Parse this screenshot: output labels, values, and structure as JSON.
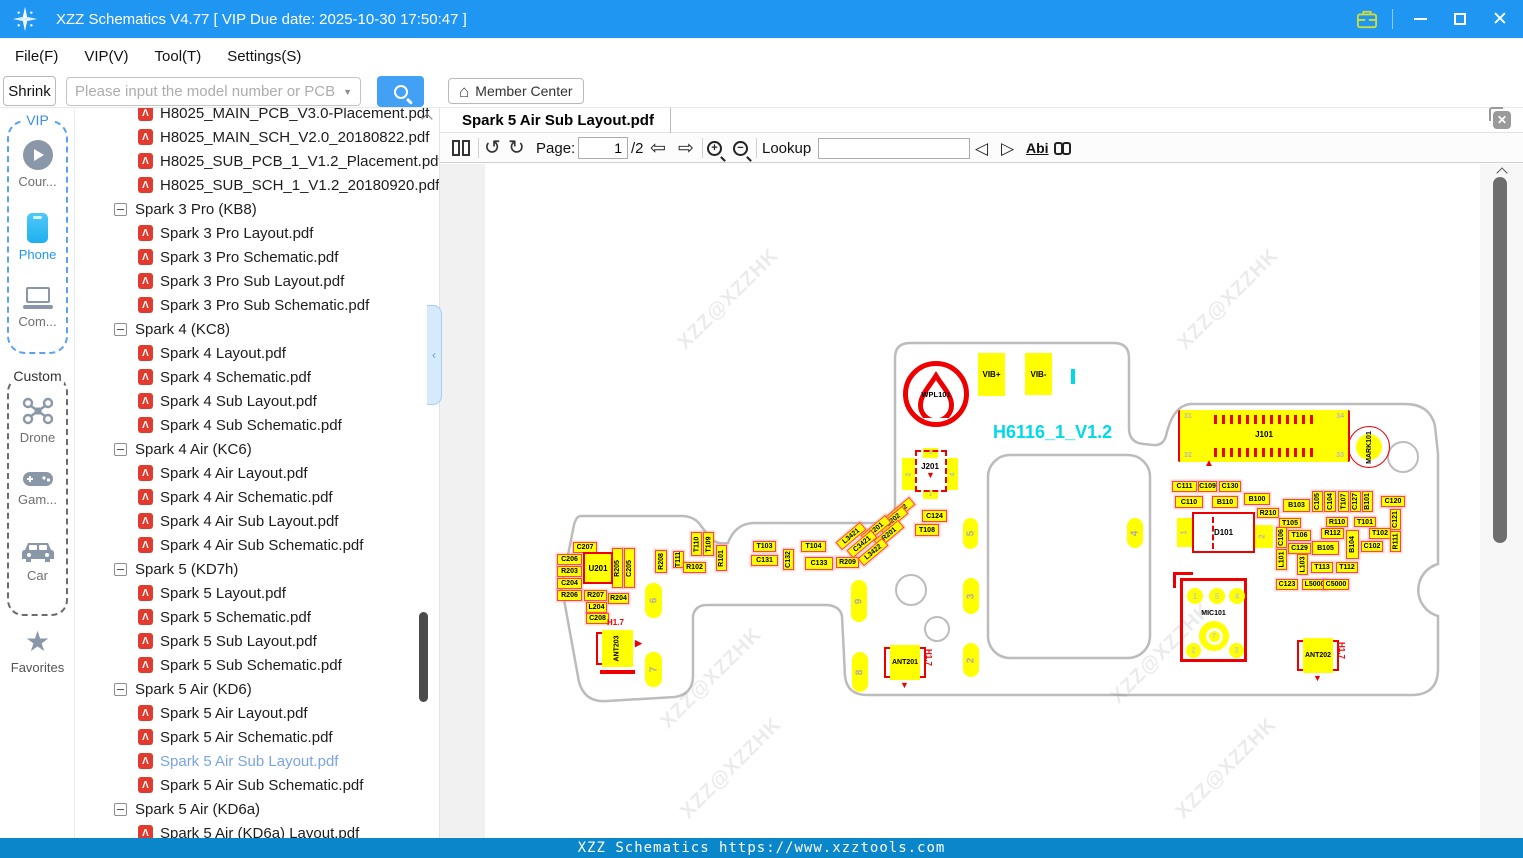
{
  "titlebar": {
    "title": "XZZ Schematics V4.77 [ VIP Due date: 2025-10-30 17:50:47 ]"
  },
  "menubar": {
    "items": [
      "File(F)",
      "VIP(V)",
      "Tool(T)",
      "Settings(S)"
    ]
  },
  "searchbar": {
    "shrink_label": "Shrink",
    "placeholder": "Please input the model number or PCB",
    "member_center_label": "Member Center"
  },
  "sidebar": {
    "vip_label": "VIP",
    "custom_label": "Custom",
    "favorites_label": "Favorites",
    "vip_items": [
      {
        "label": "Cour...",
        "icon": "play-circle-icon"
      },
      {
        "label": "Phone",
        "icon": "phone-icon",
        "active": true
      },
      {
        "label": "Com...",
        "icon": "laptop-icon"
      }
    ],
    "custom_items": [
      {
        "label": "Drone",
        "icon": "drone-icon"
      },
      {
        "label": "Gam...",
        "icon": "gamepad-icon"
      },
      {
        "label": "Car",
        "icon": "car-icon"
      }
    ]
  },
  "tree": {
    "items": [
      {
        "type": "file",
        "label": "H8025_MAIN_PCB_V3.0-Placement.pdf"
      },
      {
        "type": "file",
        "label": "H8025_MAIN_SCH_V2.0_20180822.pdf"
      },
      {
        "type": "file",
        "label": "H8025_SUB_PCB_1_V1.2_Placement.pdf"
      },
      {
        "type": "file",
        "label": "H8025_SUB_SCH_1_V1.2_20180920.pdf"
      },
      {
        "type": "group",
        "label": "Spark 3 Pro (KB8)"
      },
      {
        "type": "file",
        "label": "Spark 3 Pro Layout.pdf"
      },
      {
        "type": "file",
        "label": "Spark 3 Pro Schematic.pdf"
      },
      {
        "type": "file",
        "label": "Spark 3 Pro Sub Layout.pdf"
      },
      {
        "type": "file",
        "label": "Spark 3 Pro Sub Schematic.pdf"
      },
      {
        "type": "group",
        "label": "Spark 4 (KC8)"
      },
      {
        "type": "file",
        "label": "Spark 4 Layout.pdf"
      },
      {
        "type": "file",
        "label": "Spark 4 Schematic.pdf"
      },
      {
        "type": "file",
        "label": "Spark 4 Sub Layout.pdf"
      },
      {
        "type": "file",
        "label": "Spark 4 Sub Schematic.pdf"
      },
      {
        "type": "group",
        "label": "Spark 4 Air (KC6)"
      },
      {
        "type": "file",
        "label": "Spark 4 Air Layout.pdf"
      },
      {
        "type": "file",
        "label": "Spark 4 Air Schematic.pdf"
      },
      {
        "type": "file",
        "label": "Spark 4 Air Sub Layout.pdf"
      },
      {
        "type": "file",
        "label": "Spark 4 Air Sub Schematic.pdf"
      },
      {
        "type": "group",
        "label": "Spark 5 (KD7h)"
      },
      {
        "type": "file",
        "label": "Spark 5 Layout.pdf"
      },
      {
        "type": "file",
        "label": "Spark 5 Schematic.pdf"
      },
      {
        "type": "file",
        "label": "Spark 5 Sub Layout.pdf"
      },
      {
        "type": "file",
        "label": "Spark 5 Sub Schematic.pdf"
      },
      {
        "type": "group",
        "label": "Spark 5 Air (KD6)"
      },
      {
        "type": "file",
        "label": "Spark 5 Air Layout.pdf"
      },
      {
        "type": "file",
        "label": "Spark 5 Air Schematic.pdf"
      },
      {
        "type": "file",
        "label": "Spark 5 Air Sub Layout.pdf",
        "selected": true
      },
      {
        "type": "file",
        "label": "Spark 5 Air Sub Schematic.pdf"
      },
      {
        "type": "group",
        "label": "Spark 5 Air (KD6a)"
      },
      {
        "type": "file",
        "label": "Spark 5 Air (KD6a) Layout.pdf"
      }
    ]
  },
  "tabbar": {
    "active_tab": "Spark 5 Air Sub Layout.pdf"
  },
  "viewer_toolbar": {
    "page_label": "Page:",
    "page_value": "1",
    "page_total": "/2",
    "lookup_label": "Lookup",
    "lookup_value": "",
    "abi_label": "Abi"
  },
  "statusbar": {
    "text": "XZZ Schematics https://www.xzztools.com"
  },
  "pcb": {
    "board_title": "H6116_1_V1.2",
    "watermark_text": "XZZ@XZZHK",
    "colors": {
      "component": "#ffff00",
      "marking": "#ee0000",
      "outline": "#bcbcbc",
      "cyan": "#00d9e8"
    },
    "watermarks": [
      [
        247,
        136
      ],
      [
        747,
        136
      ],
      [
        230,
        515
      ],
      [
        680,
        490
      ],
      [
        250,
        605
      ],
      [
        745,
        605
      ]
    ],
    "labels": [
      [
        "C207",
        88,
        378,
        24,
        11,
        0
      ],
      [
        "C206",
        72,
        390,
        25,
        11,
        0
      ],
      [
        "R203",
        72,
        402,
        25,
        11,
        0
      ],
      [
        "C204",
        72,
        414,
        25,
        11,
        0
      ],
      [
        "R206",
        72,
        426,
        25,
        11,
        0
      ],
      [
        "R207",
        99,
        426,
        23,
        11,
        0
      ],
      [
        "R204",
        123,
        429,
        21,
        11,
        0
      ],
      [
        "L204",
        101,
        438,
        21,
        11,
        0
      ],
      [
        "C208",
        101,
        449,
        23,
        11,
        0
      ],
      [
        "R205",
        127,
        384,
        11,
        40,
        1
      ],
      [
        "C205",
        139,
        384,
        11,
        40,
        1
      ],
      [
        "R208",
        170,
        386,
        12,
        23,
        1
      ],
      [
        "T111",
        188,
        387,
        11,
        17,
        1
      ],
      [
        "T110",
        206,
        368,
        11,
        24,
        1
      ],
      [
        "T109",
        218,
        368,
        11,
        24,
        1
      ],
      [
        "R102",
        198,
        398,
        23,
        11,
        0
      ],
      [
        "R101",
        231,
        381,
        11,
        26,
        1
      ],
      [
        "T103",
        268,
        377,
        23,
        11,
        0
      ],
      [
        "C131",
        266,
        391,
        27,
        11,
        0
      ],
      [
        "C132",
        298,
        385,
        11,
        21,
        1
      ],
      [
        "T104",
        316,
        377,
        25,
        11,
        0
      ],
      [
        "C133",
        320,
        393,
        28,
        13,
        0
      ],
      [
        "R209",
        351,
        393,
        23,
        11,
        0
      ],
      [
        "C124",
        437,
        346,
        25,
        12,
        0
      ],
      [
        "T108",
        430,
        360,
        24,
        12,
        0
      ],
      [
        "C111",
        687,
        317,
        25,
        11,
        0
      ],
      [
        "C109",
        713,
        317,
        19,
        11,
        0
      ],
      [
        "C130",
        734,
        317,
        22,
        11,
        0
      ],
      [
        "C110",
        690,
        332,
        28,
        12,
        0
      ],
      [
        "B110",
        727,
        332,
        26,
        12,
        0
      ],
      [
        "B100",
        759,
        329,
        26,
        12,
        0
      ],
      [
        "B103",
        798,
        335,
        27,
        13,
        0
      ],
      [
        "R210",
        772,
        344,
        22,
        10,
        0
      ],
      [
        "T105",
        794,
        354,
        22,
        10,
        0
      ],
      [
        "C105",
        827,
        327,
        11,
        21,
        1
      ],
      [
        "C104",
        839,
        327,
        12,
        21,
        1
      ],
      [
        "T107",
        853,
        327,
        11,
        21,
        1
      ],
      [
        "C127",
        865,
        327,
        11,
        21,
        1
      ],
      [
        "B101",
        877,
        327,
        11,
        21,
        1
      ],
      [
        "C120",
        896,
        332,
        24,
        11,
        0
      ],
      [
        "C121",
        905,
        345,
        11,
        21,
        1
      ],
      [
        "R110",
        841,
        353,
        22,
        10,
        0
      ],
      [
        "T101",
        869,
        353,
        22,
        10,
        0
      ],
      [
        "R112",
        836,
        364,
        23,
        11,
        0
      ],
      [
        "T102",
        884,
        364,
        22,
        11,
        0
      ],
      [
        "R111",
        905,
        367,
        11,
        21,
        1
      ],
      [
        "C106",
        791,
        363,
        11,
        21,
        1
      ],
      [
        "T106",
        803,
        366,
        23,
        11,
        0
      ],
      [
        "B104",
        861,
        366,
        13,
        29,
        1
      ],
      [
        "C102",
        876,
        377,
        22,
        11,
        0
      ],
      [
        "C129",
        803,
        379,
        23,
        11,
        0
      ],
      [
        "B105",
        827,
        377,
        27,
        14,
        0
      ],
      [
        "L101",
        791,
        385,
        11,
        21,
        1
      ],
      [
        "L103",
        812,
        390,
        11,
        21,
        1
      ],
      [
        "T113",
        826,
        398,
        22,
        11,
        0
      ],
      [
        "T112",
        851,
        398,
        22,
        11,
        0
      ],
      [
        "C123",
        791,
        415,
        22,
        11,
        0
      ],
      [
        "L5000",
        817,
        415,
        25,
        11,
        0
      ],
      [
        "C5000",
        838,
        415,
        26,
        11,
        0
      ]
    ],
    "diagonal_labels": [
      [
        "R212",
        415,
        347
      ],
      [
        "C202",
        408,
        356
      ],
      [
        "C201",
        391,
        365
      ],
      [
        "R201",
        404,
        370
      ],
      [
        "L3421",
        366,
        372
      ],
      [
        "C3421",
        377,
        380
      ],
      [
        "L3422",
        388,
        388
      ]
    ],
    "edge_pads": [
      [
        "6",
        160,
        419,
        17,
        35
      ],
      [
        "7",
        160,
        488,
        17,
        35
      ],
      [
        "9",
        366,
        416,
        16,
        42
      ],
      [
        "8",
        367,
        488,
        16,
        40
      ],
      [
        "3",
        478,
        414,
        16,
        36
      ],
      [
        "2",
        478,
        479,
        16,
        34
      ],
      [
        "5",
        478,
        354,
        15,
        31
      ],
      [
        "4",
        642,
        354,
        16,
        30
      ]
    ],
    "holes": [
      [
        426,
        426,
        16
      ],
      [
        452,
        465,
        13
      ],
      [
        918,
        293,
        16
      ]
    ],
    "u201": {
      "ref": "U201",
      "x": 98,
      "y": 388,
      "w": 30,
      "h": 32
    },
    "vib_pads": [
      {
        "ref": "VIB+",
        "x": 493,
        "y": 189,
        "w": 27,
        "h": 43
      },
      {
        "ref": "VIB-",
        "x": 540,
        "y": 189,
        "w": 27,
        "h": 42
      }
    ],
    "wpl101": {
      "ref": "WPL101",
      "cx": 451,
      "cy": 230,
      "r": 33
    },
    "j201": {
      "ref": "J201",
      "x": 415,
      "y": 282,
      "pins": [
        "3",
        "2",
        "4",
        "1"
      ]
    },
    "j101": {
      "ref": "J101",
      "x": 693,
      "y": 246,
      "w": 172,
      "h": 52,
      "pins": [
        "31",
        "32",
        "33",
        "34"
      ]
    },
    "mark101": {
      "ref": "MARK101",
      "cx": 884,
      "cy": 283,
      "r": 21
    },
    "d101": {
      "ref": "D101",
      "x": 707,
      "y": 348,
      "w": 63,
      "h": 41,
      "pins": [
        "1",
        "2"
      ]
    },
    "mic101": {
      "ref": "MIC101",
      "x": 695,
      "y": 414,
      "w": 67,
      "h": 84,
      "pins": [
        "1",
        "5",
        "4",
        "2",
        "3",
        "7"
      ]
    },
    "antennas": [
      {
        "ref": "ANT203",
        "x": 117,
        "y": 466,
        "w": 31,
        "h": 37,
        "vertical_label": true,
        "h17": "H1.7",
        "h17_pos": "above",
        "tri": "right"
      },
      {
        "ref": "ANT201",
        "x": 405,
        "y": 481,
        "w": 30,
        "h": 35,
        "vertical_label": false,
        "h17": "H1.7",
        "h17_pos": "right",
        "tri": "down"
      },
      {
        "ref": "ANT202",
        "x": 818,
        "y": 474,
        "w": 30,
        "h": 35,
        "vertical_label": false,
        "h17": "H1.7",
        "h17_pos": "right",
        "tri": "down"
      }
    ],
    "cyan_mark_xy": [
      586,
      205
    ]
  }
}
